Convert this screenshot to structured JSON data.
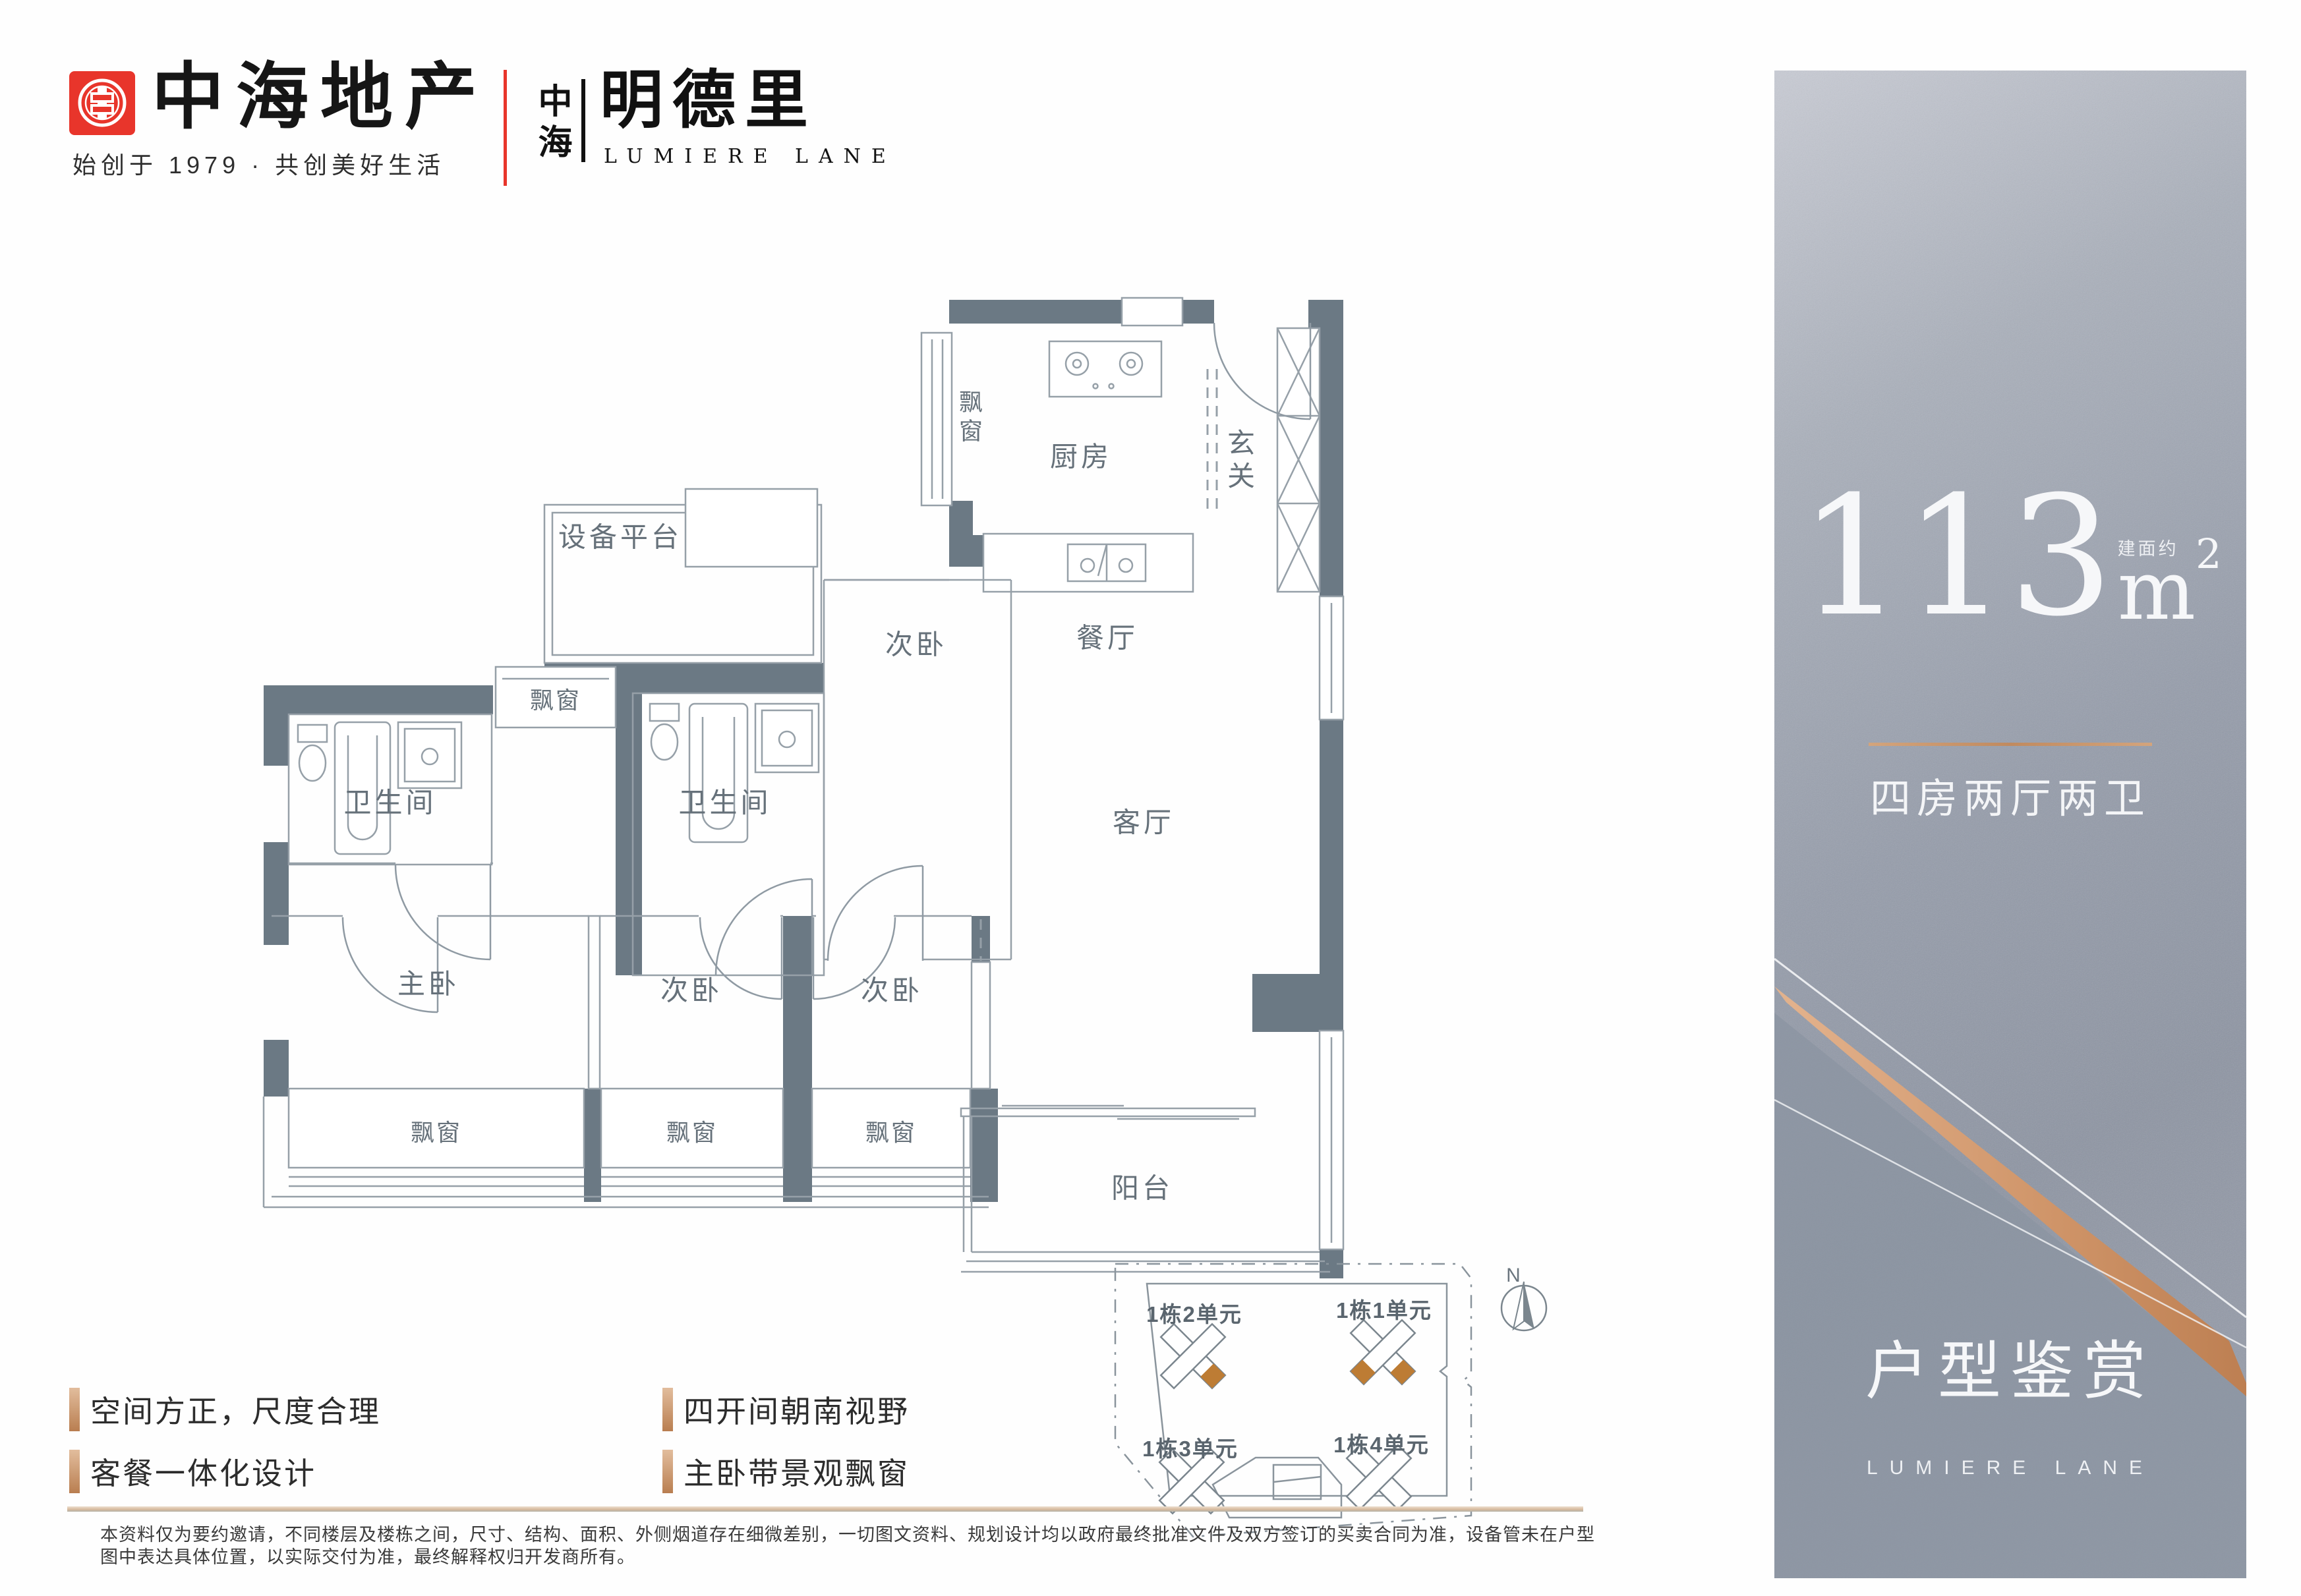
{
  "header": {
    "brand_name": "中海地产",
    "brand_tagline": "始创于 1979 · 共创美好生活",
    "project_brand": "中海",
    "project_name": "明德里",
    "project_name_en": "LUMIERE LANE"
  },
  "floor_plan": {
    "rooms": {
      "bay_kitchen": "飘窗",
      "kitchen": "厨房",
      "entry": "玄关",
      "equipment_platform": "设备平台",
      "bedroom_top": "次卧",
      "dining": "餐厅",
      "bath_shared": "卫生间",
      "bay_small": "飘窗",
      "bath_master": "卫生间",
      "living": "客厅",
      "master": "主卧",
      "bedroom2": "次卧",
      "bedroom3": "次卧",
      "bay_master": "飘窗",
      "bay_bed2": "飘窗",
      "bay_bed3": "飘窗",
      "balcony": "阳台"
    }
  },
  "site_plan": {
    "units": [
      "1栋2单元",
      "1栋1单元",
      "1栋3单元",
      "1栋4单元"
    ],
    "north_label": "N",
    "highlight_color": "#bd7c34"
  },
  "panel": {
    "area_value": "113",
    "area_unit": "m",
    "area_sup": "2",
    "area_prefix": "建面约",
    "layout": "四房两厅两卫",
    "title": "户型鉴赏",
    "subtitle": "LUMIERE LANE",
    "accent_color": "#c08a5f"
  },
  "features": [
    "空间方正，尺度合理",
    "四开间朝南视野",
    "客餐一体化设计",
    "主卧带景观飘窗"
  ],
  "disclaimer": "本资料仅为要约邀请，不同楼层及楼栋之间，尺寸、结构、面积、外侧烟道存在细微差别，一切图文资料、规划设计均以政府最终批准文件及双方签订的买卖合同为准，设备管未在户型图中表达具体位置，以实际交付为准，最终解释权归开发商所有。"
}
